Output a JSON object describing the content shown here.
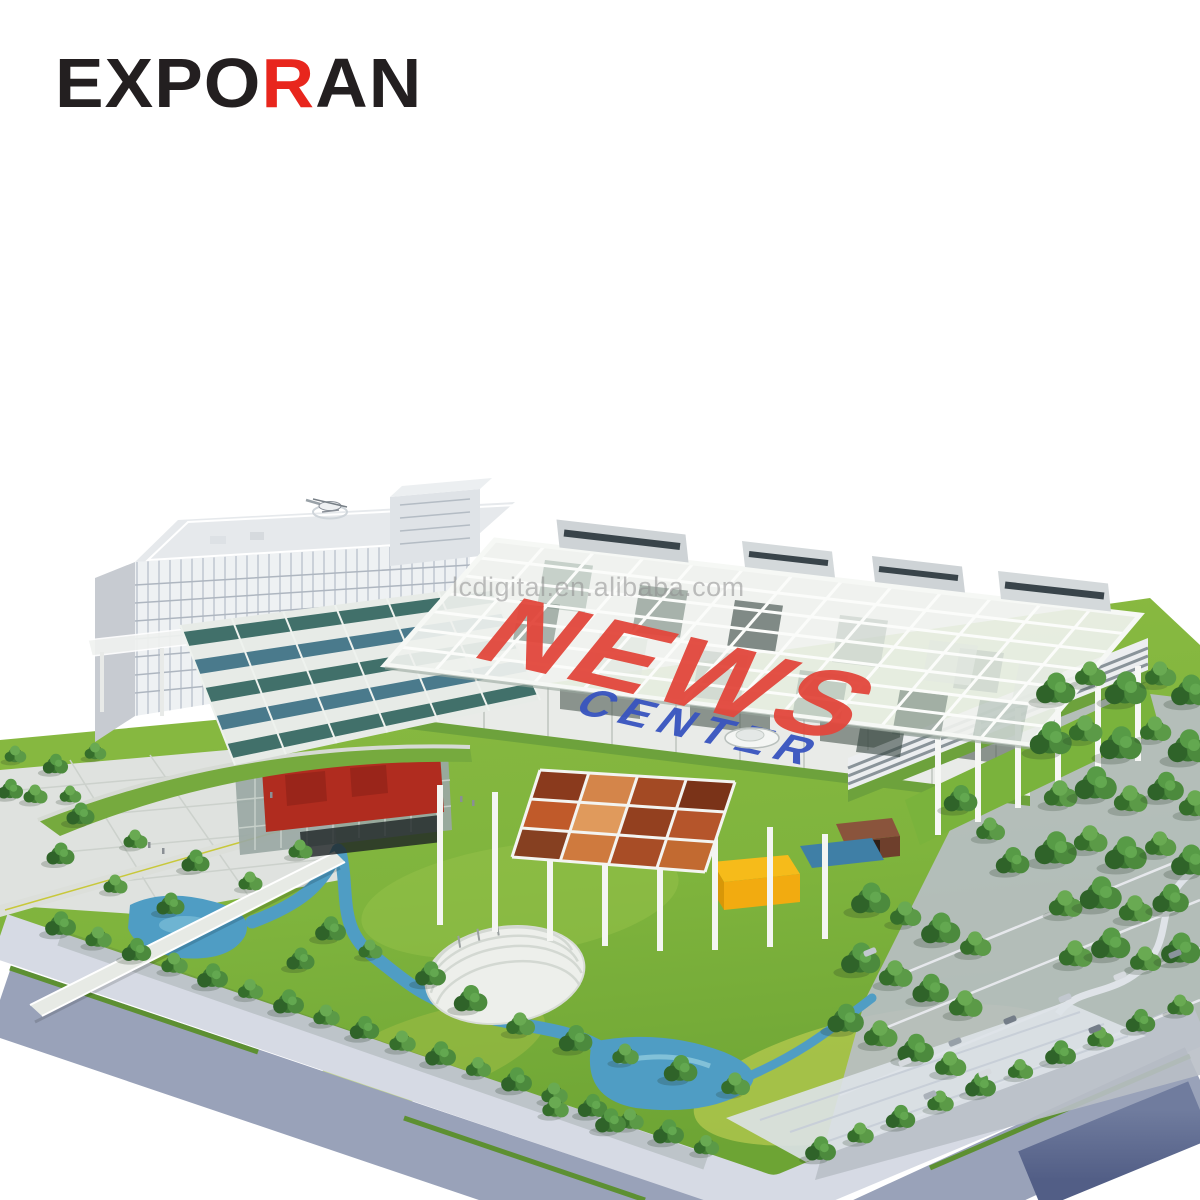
{
  "brand": {
    "name": "EXPORAN",
    "prefix": "EXPO",
    "accent_letter": "R",
    "suffix": "AN",
    "color_black": "#231f20",
    "color_red": "#e8261d"
  },
  "watermark": {
    "text": "lcdigital.en.alibaba.com",
    "color": "#8f8f8f"
  },
  "roof_sign": {
    "word1": "NEWS",
    "word1_color": "#e2473c",
    "word2": "CENTER",
    "word2_color": "#3854bf"
  },
  "palette": {
    "background": "#ffffff",
    "grass": "#7fb43d",
    "grass_light": "#b7cb51",
    "tree_dark": "#2f6529",
    "tree_mid": "#47853a",
    "water": "#4f9dc4",
    "road": "#99a2b9",
    "sidewalk": "#d6dae4",
    "base_side": "#5c6890",
    "structure_white": "#f1f3f0",
    "glass_teal": "#41706a",
    "glass_blue": "#4a7a8c",
    "red_box": "#b02c1f",
    "yellow_pavilion": "#f2ab10",
    "brown_pavilion": "#7d4a35",
    "hedge": "#5d9032",
    "mural_orange": "#c96f33"
  }
}
